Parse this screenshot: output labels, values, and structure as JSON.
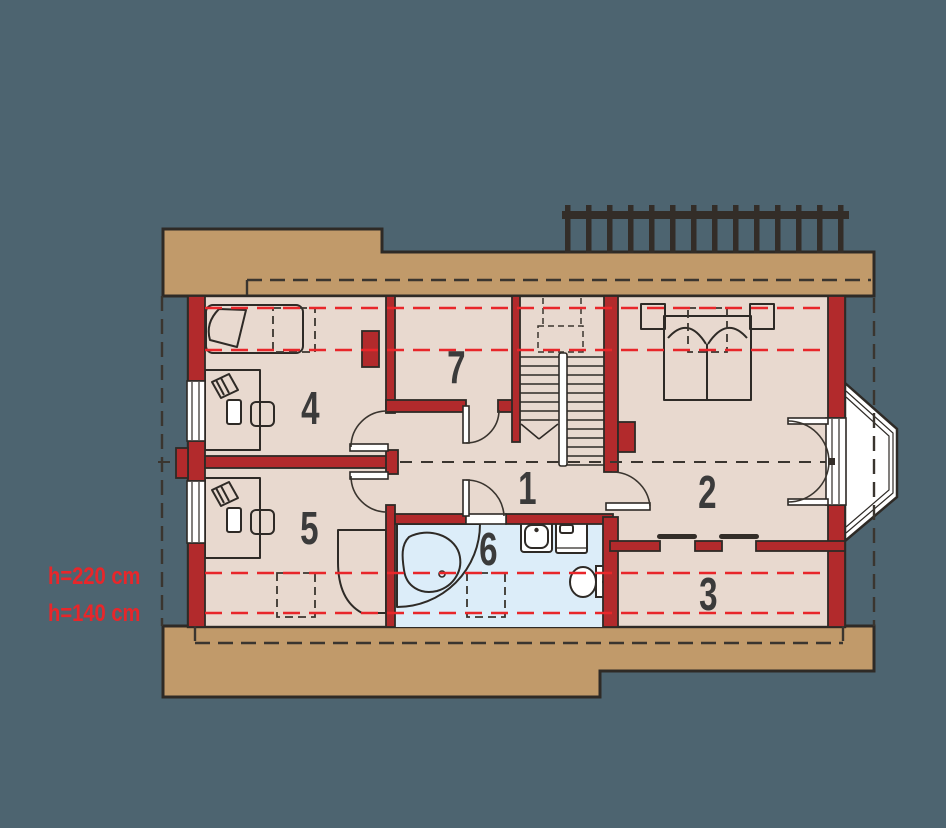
{
  "palette": {
    "background": "#4d6470",
    "roof-band": "#c19a6a",
    "floor": "#e8d9cf",
    "bath-floor": "#dcedf9",
    "wall": "#b22a2c",
    "line": "#2e2a26",
    "height-line": "#e8262a",
    "label": "#3b3b3b",
    "railing": "#332d28"
  },
  "plan": {
    "room_labels": [
      "1",
      "2",
      "3",
      "4",
      "5",
      "6",
      "7"
    ],
    "height_labels": [
      "h=220 cm",
      "h=140 cm"
    ]
  }
}
